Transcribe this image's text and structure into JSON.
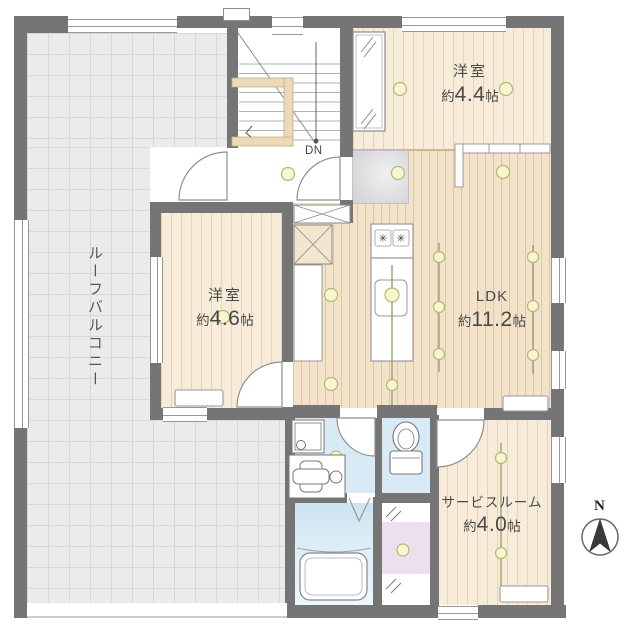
{
  "plan": {
    "compass_label": "N",
    "stairs_label": "DN",
    "balcony": {
      "label": "ルーフバルコニー"
    },
    "rooms": {
      "western_small": {
        "label": "洋室",
        "size_prefix": "約",
        "size": "4.4",
        "unit": "帖"
      },
      "western": {
        "label": "洋室",
        "size_prefix": "約",
        "size": "4.6",
        "unit": "帖"
      },
      "ldk": {
        "label": "LDK",
        "size_prefix": "約",
        "size": "11.2",
        "unit": "帖"
      },
      "service": {
        "label": "サービスルーム",
        "size_prefix": "約",
        "size": "4.0",
        "unit": "帖"
      }
    },
    "kitchen": {
      "burner_glyph": "✳"
    },
    "colors": {
      "wall": "#757575",
      "wood_floor": "#f7ecd9",
      "ldk_floor": "#f2e2c9",
      "balcony_floor": "#eceaed",
      "water_floor": "#d7eaf5",
      "pink_floor": "#ecdfee",
      "light_fill": "#f9f5cf",
      "light_stroke": "#b3b878",
      "green_line": "#9aa168",
      "banister": "#ecd9b8"
    }
  }
}
